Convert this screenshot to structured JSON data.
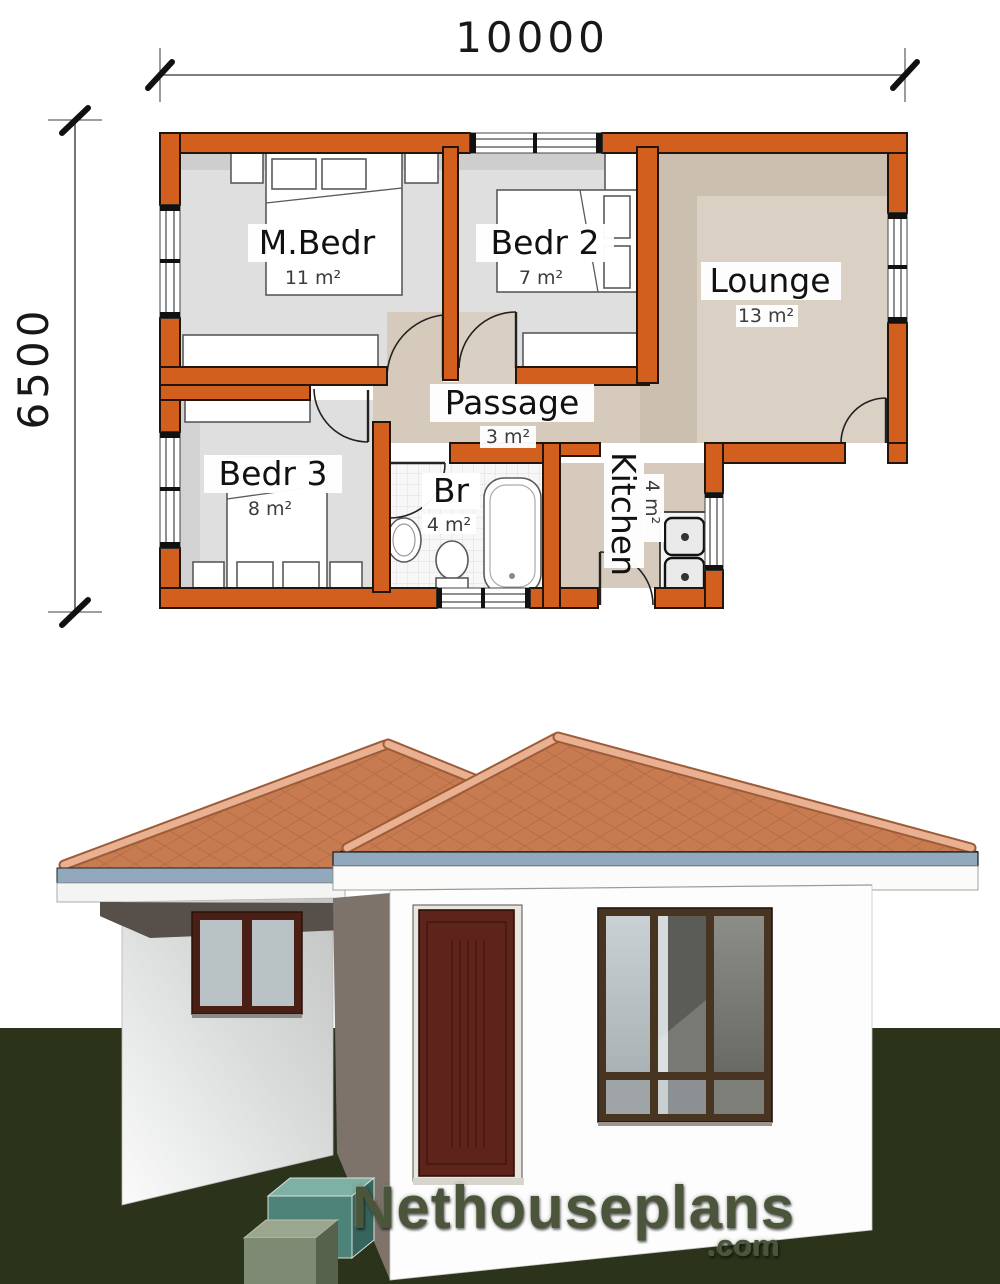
{
  "floor_plan": {
    "dim_top": "10000",
    "dim_left": "6500",
    "rooms": [
      {
        "name": "M.Bedr",
        "area": "11 m²"
      },
      {
        "name": "Bedr 2",
        "area": "7 m²"
      },
      {
        "name": "Lounge",
        "area": "13 m²"
      },
      {
        "name": "Passage",
        "area": "3 m²"
      },
      {
        "name": "Bedr 3",
        "area": "8 m²"
      },
      {
        "name": "Br",
        "area": "4 m²"
      },
      {
        "name": "Kitchen",
        "area": "4 m²"
      }
    ],
    "colors": {
      "wall_orange": "#d35f1f",
      "bedroom_floor": "#dfdfdf",
      "lounge_floor": "#d9cfc2",
      "bathroom_floor": "#f7f7f7"
    }
  },
  "render_3d": {
    "colors": {
      "roof_tile": "#c87b50",
      "roof_ridge": "#e9b091",
      "fascia_blue": "#92a8bc",
      "wall_white": "#fdfdfd",
      "door_maroon": "#5e231b",
      "window_frame": "#473522",
      "grass_green": "#2b331a"
    }
  },
  "logo": {
    "name": "Nethouseplans",
    "tld": ".com"
  }
}
